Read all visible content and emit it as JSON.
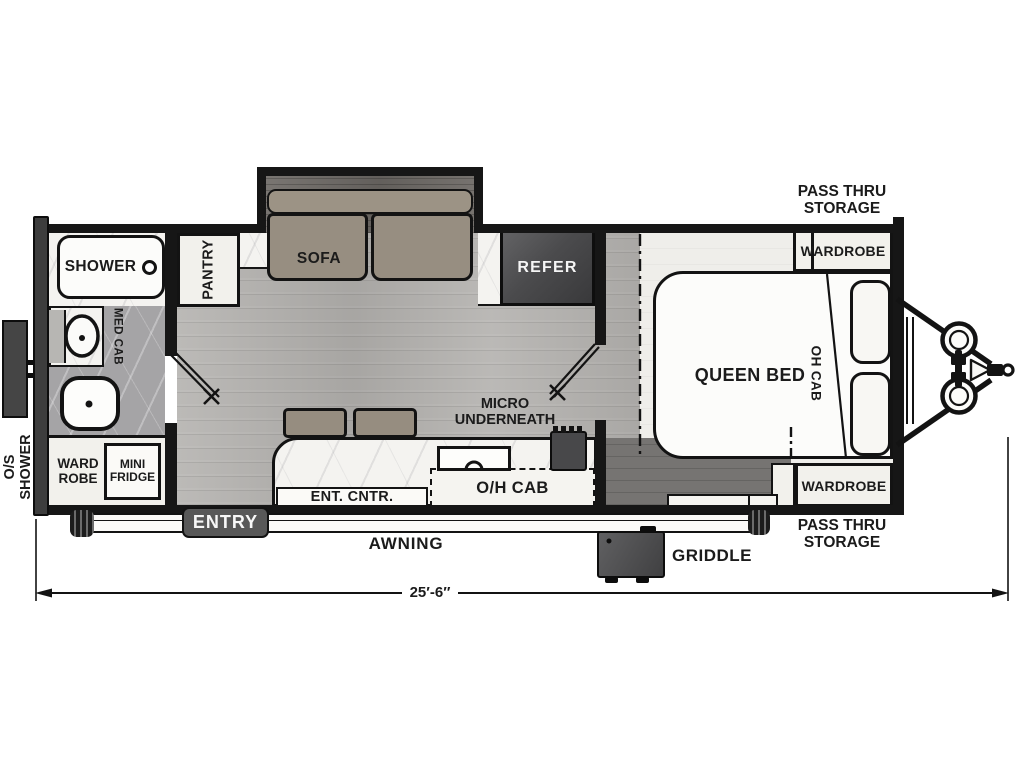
{
  "floorplan": {
    "dimension_label": "25′-6″",
    "exterior": {
      "pass_thru_storage_top": [
        "PASS THRU",
        "STORAGE"
      ],
      "pass_thru_storage_bottom": [
        "PASS THRU",
        "STORAGE"
      ],
      "os_shower": [
        "O/S",
        "SHOWER"
      ],
      "awning": "AWNING",
      "entry": "ENTRY",
      "griddle": "GRIDDLE"
    },
    "bathroom": {
      "shower": "SHOWER",
      "med_cab": "MED CAB",
      "wardrobe": [
        "WARD",
        "ROBE"
      ],
      "mini_fridge": [
        "MINI",
        "FRIDGE"
      ]
    },
    "living": {
      "pantry": "PANTRY",
      "sofa": "SOFA",
      "refer": "REFER",
      "ent_cntr": "ENT. CNTR.",
      "oh_cab": "O/H CAB",
      "micro": [
        "MICRO",
        "UNDERNEATH"
      ]
    },
    "bedroom": {
      "queen_bed": "QUEEN BED",
      "oh_cab": "OH CAB",
      "wardrobe_top": "WARDROBE",
      "wardrobe_bottom": "WARDROBE"
    },
    "colors": {
      "wall": "#161616",
      "upholstery": "#978e81",
      "appliance_dark": "#4a4a4c",
      "wood_floor": "#b4b2af",
      "marble": "#f4f3f0",
      "badge_dark": "#585858"
    }
  }
}
